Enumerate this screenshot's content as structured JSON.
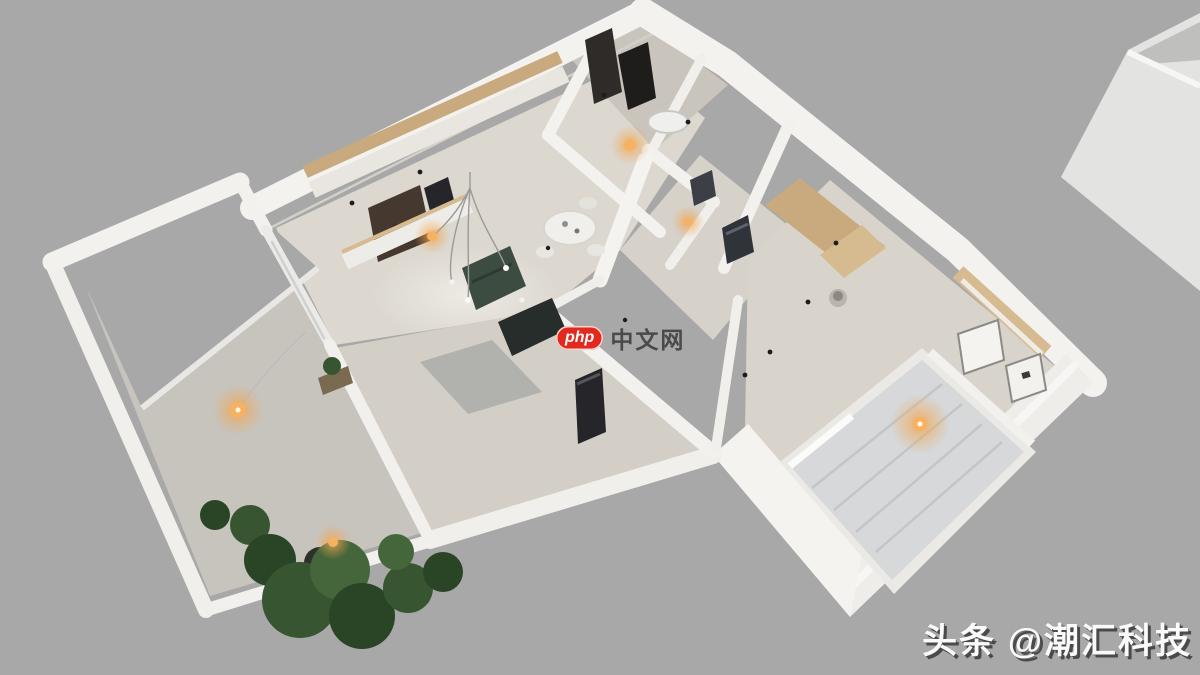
{
  "background": "#a8a8a8",
  "watermarks": {
    "center": {
      "badge": "php",
      "badge_bg": "#e3281e",
      "label": "中文网",
      "label_color": "#3a3a3a"
    },
    "corner": {
      "text": "头条 @潮汇科技",
      "color": "#fafafa",
      "shadow": "#4a4a4a"
    }
  },
  "palette": {
    "wall": "#f3f2ef",
    "wall_shade": "#e9e7e3",
    "floor_living": "#dcd8d0",
    "floor_mid": "#d3cfc7",
    "floor_bath": "#c9c4bc",
    "floor_bedroom": "#d9d4cb",
    "floor_balcony": "#c7c4be",
    "floor_hall": "#d6d1c9",
    "wood": "#c8aa7e",
    "wood_light": "#d6bb90",
    "niche_dark": "#45382e",
    "appliance_dark": "#26262a",
    "sofa_green": "#3c4c41",
    "bench_dark": "#262d2b",
    "mattress": "#d6d8d9",
    "mattress_stripe": "#c3c6c8",
    "bed_frame": "#eae9e5",
    "plant_dark": "#2a4426",
    "plant_mid": "#365530",
    "plant_light": "#44663a",
    "glow_core": "#f7b162",
    "glow_halo": "#f2a650",
    "neighbor_block": "#e3e3e2",
    "neighbor_interior": "#bfbfbd"
  },
  "lights": [
    {
      "x": 238,
      "y": 410,
      "halo_r": 26,
      "core_r": 8
    },
    {
      "x": 333,
      "y": 542,
      "halo_r": 18,
      "core_r": 5
    },
    {
      "x": 432,
      "y": 236,
      "halo_r": 18,
      "core_r": 5
    },
    {
      "x": 630,
      "y": 145,
      "halo_r": 20,
      "core_r": 6
    },
    {
      "x": 688,
      "y": 222,
      "halo_r": 16,
      "core_r": 4
    },
    {
      "x": 920,
      "y": 424,
      "halo_r": 30,
      "core_r": 7
    }
  ]
}
